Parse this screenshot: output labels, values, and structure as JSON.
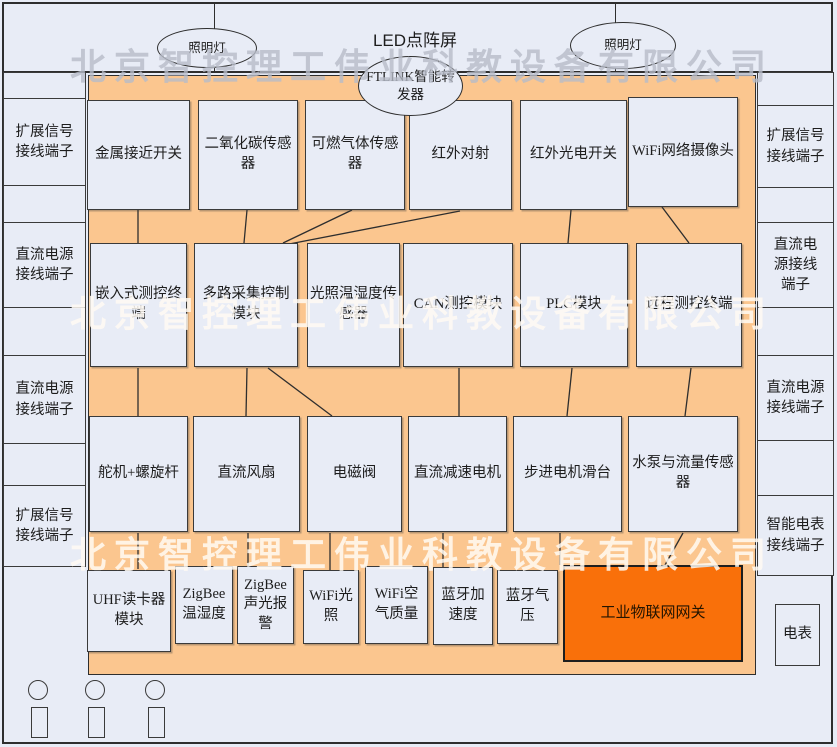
{
  "company_watermark": "北京智控理工伟业科教设备有限公司",
  "top": {
    "led_screen_label": "LED点阵屏",
    "left_lamp_label": "照明灯",
    "right_lamp_label": "照明灯",
    "ftlink_label": "FTLINK智能转发器"
  },
  "left_terminal_column": [
    "扩展信号接线端子",
    "直流电源接线端子",
    "直流电源接线端子",
    "扩展信号接线端子"
  ],
  "right_terminal_column": [
    "扩展信号接线端子",
    "直流电源接线端子",
    "直流电源接线端子",
    "智能电表接线端子"
  ],
  "panel": {
    "row1": [
      "金属接近开关",
      "二氧化碳传感器",
      "可燃气体传感器",
      "红外对射",
      "红外光电开关",
      "WiFi网络摄像头"
    ],
    "row2": [
      "嵌入式测控终端",
      "多路采集控制模块",
      "光照温湿度传感器",
      "CAN测控模块",
      "PLC模块",
      "远程测控终端"
    ],
    "row3": [
      "舵机+螺旋杆",
      "直流风扇",
      "电磁阀",
      "直流减速电机",
      "步进电机滑台",
      "水泵与流量传感器"
    ],
    "row4": [
      "UHF读卡器模块",
      "ZigBee温湿度",
      "ZigBee声光报警",
      "WiFi光照",
      "WiFi空气质量",
      "蓝牙加速度",
      "蓝牙气压"
    ],
    "gateway": "工业物联网网关"
  },
  "meter_label": "电表",
  "colors": {
    "background": "#E8ECF6",
    "panel_fill": "#FBC68F",
    "box_fill": "#E8ECF6",
    "gateway_fill": "#F9700A",
    "border": "#3A3A3A"
  }
}
